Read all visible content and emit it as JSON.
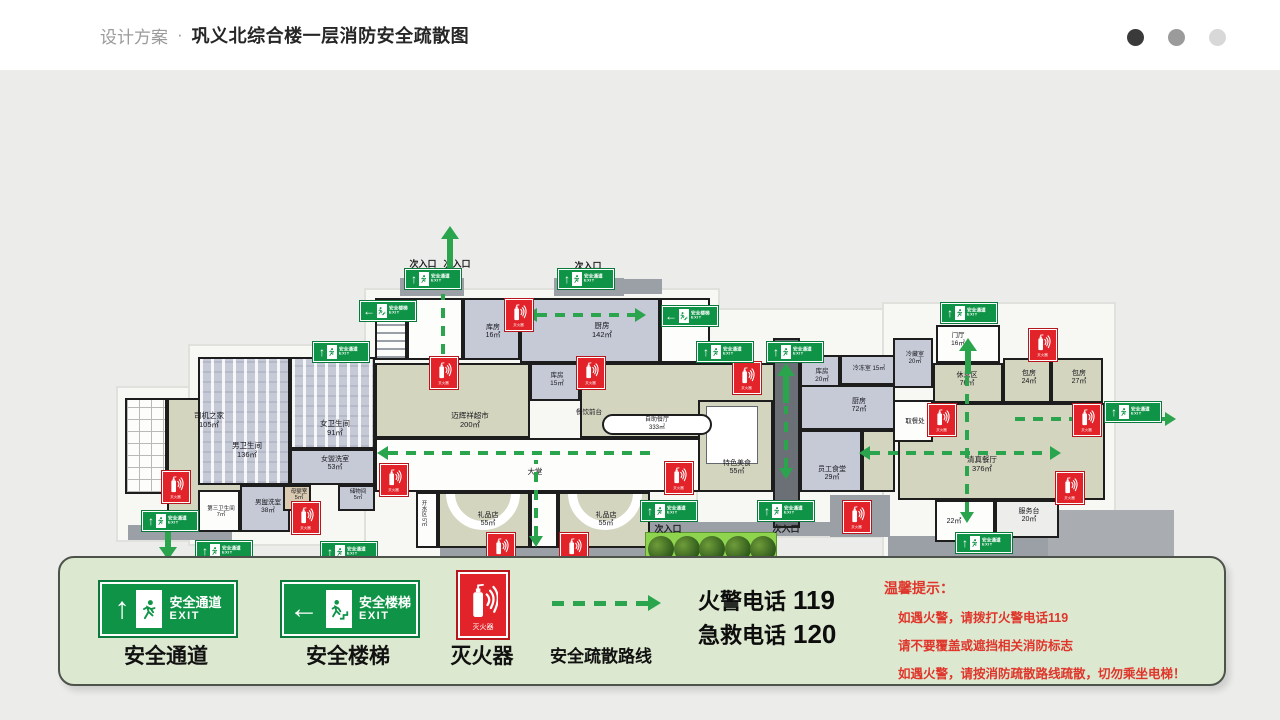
{
  "header": {
    "brand": "设计方案",
    "separator": "·",
    "title": "巩义北综合楼一层消防安全疏散图",
    "dots": [
      "#3a3a3a",
      "#9b9b9b",
      "#d8d8d8"
    ]
  },
  "colors": {
    "exit_green": "#0f9447",
    "extinguisher_red": "#e2232a",
    "route_green": "#2aa44d",
    "legend_bg": "#dce8cf",
    "tips_red": "#e0352b"
  },
  "sign_text": {
    "passage": "安全通道",
    "stairs": "安全楼梯",
    "exit": "EXIT",
    "extinguisher": "灭火器"
  },
  "legend": {
    "items": [
      {
        "label": "安全通道"
      },
      {
        "label": "安全楼梯"
      },
      {
        "label": "灭火器"
      },
      {
        "label": "安全疏散路线"
      }
    ],
    "phones": [
      {
        "label": "火警电话",
        "number": "119"
      },
      {
        "label": "急救电话",
        "number": "120"
      }
    ],
    "tips": {
      "title": "温馨提示：",
      "lines": [
        "如遇火警，请拨打火警电话119",
        "请不要覆盖或遮挡相关消防标志",
        "如遇火警，请按消防疏散路线疏散，切勿乘坐电梯！"
      ]
    }
  },
  "floorplan": {
    "silhouettes": [
      {
        "x": 118,
        "y": 318,
        "w": 138,
        "h": 152
      },
      {
        "x": 190,
        "y": 276,
        "w": 194,
        "h": 198
      },
      {
        "x": 366,
        "y": 220,
        "w": 352,
        "h": 266
      },
      {
        "x": 698,
        "y": 240,
        "w": 202,
        "h": 226
      },
      {
        "x": 884,
        "y": 234,
        "w": 230,
        "h": 258
      }
    ],
    "platforms": [
      {
        "x": 400,
        "y": 208,
        "w": 64,
        "h": 18
      },
      {
        "x": 554,
        "y": 208,
        "w": 70,
        "h": 18
      },
      {
        "x": 610,
        "y": 209,
        "w": 52,
        "h": 15
      },
      {
        "x": 128,
        "y": 455,
        "w": 104,
        "h": 15
      },
      {
        "x": 440,
        "y": 478,
        "w": 208,
        "h": 14
      },
      {
        "x": 490,
        "y": 492,
        "w": 124,
        "h": 24,
        "c": "#8a9095"
      },
      {
        "x": 618,
        "y": 452,
        "w": 218,
        "h": 14
      },
      {
        "x": 830,
        "y": 425,
        "w": 60,
        "h": 42
      },
      {
        "x": 888,
        "y": 466,
        "w": 162,
        "h": 26
      },
      {
        "x": 1048,
        "y": 440,
        "w": 126,
        "h": 58,
        "c": "#a9adb2"
      }
    ],
    "rooms": [
      {
        "x": 125,
        "y": 328,
        "w": 42,
        "h": 96,
        "f": "W",
        "pat": "grid"
      },
      {
        "n": "司机之家",
        "a": "105㎡",
        "x": 167,
        "y": 328,
        "w": 80,
        "h": 128,
        "f": "G",
        "lx": 207,
        "ly": 340
      },
      {
        "n": "男卫生间",
        "a": "136㎡",
        "x": 198,
        "y": 287,
        "w": 92,
        "h": 128,
        "f": "B",
        "pat": "stall",
        "lx": 245,
        "ly": 370
      },
      {
        "n": "女卫生间",
        "a": "91㎡",
        "x": 290,
        "y": 287,
        "w": 85,
        "h": 92,
        "f": "B",
        "pat": "stall",
        "lx": 333,
        "ly": 348
      },
      {
        "n": "女盥洗室",
        "a": "53㎡",
        "x": 290,
        "y": 379,
        "w": 85,
        "h": 36,
        "f": "B",
        "s": 7,
        "lx": 333,
        "ly": 384
      },
      {
        "n": "男盥洗室",
        "a": "38㎡",
        "x": 240,
        "y": 415,
        "w": 50,
        "h": 47,
        "f": "B",
        "s": 6.5,
        "lx": 266,
        "ly": 427
      },
      {
        "n": "第三卫生间",
        "a": "7㎡",
        "x": 198,
        "y": 420,
        "w": 42,
        "h": 42,
        "f": "W",
        "s": 5.5,
        "lx": 219,
        "ly": 434
      },
      {
        "n": "母婴室",
        "a": "5㎡",
        "x": 283,
        "y": 415,
        "w": 28,
        "h": 26,
        "f": "T",
        "s": 5.5,
        "lx": 297,
        "ly": 417
      },
      {
        "n": "储物间",
        "a": "5㎡",
        "x": 338,
        "y": 415,
        "w": 37,
        "h": 26,
        "f": "B",
        "s": 5.5,
        "lx": 356,
        "ly": 417
      },
      {
        "x": 375,
        "y": 228,
        "w": 32,
        "h": 62,
        "f": "W",
        "pat": "stair"
      },
      {
        "x": 407,
        "y": 228,
        "w": 56,
        "h": 62,
        "f": "W"
      },
      {
        "n": "库房",
        "a": "16㎡",
        "x": 463,
        "y": 228,
        "w": 57,
        "h": 62,
        "f": "B",
        "s": 7,
        "lx": 491,
        "ly": 252
      },
      {
        "n": "厨房",
        "a": "142㎡",
        "x": 520,
        "y": 228,
        "w": 140,
        "h": 65,
        "f": "B",
        "lx": 600,
        "ly": 250
      },
      {
        "x": 660,
        "y": 228,
        "w": 50,
        "h": 65,
        "f": "W"
      },
      {
        "n": "库房",
        "a": "15㎡",
        "x": 530,
        "y": 293,
        "w": 50,
        "h": 38,
        "f": "B",
        "s": 6.5,
        "lx": 555,
        "ly": 300
      },
      {
        "n": "迈辉祥超市",
        "a": "200㎡",
        "x": 375,
        "y": 293,
        "w": 155,
        "h": 75,
        "f": "G",
        "lx": 468,
        "ly": 340
      },
      {
        "x": 580,
        "y": 293,
        "w": 195,
        "h": 75,
        "f": "G"
      },
      {
        "n": "大堂",
        "x": 375,
        "y": 368,
        "w": 400,
        "h": 54,
        "f": "W",
        "oneline": true,
        "lx": 533,
        "ly": 396
      },
      {
        "n": "开水区",
        "a": "5㎡",
        "x": 416,
        "y": 422,
        "w": 22,
        "h": 56,
        "f": "W",
        "s": 5.5,
        "vert": true,
        "lx": 424,
        "ly": 428
      },
      {
        "n": "礼品店",
        "a": "55㎡",
        "x": 438,
        "y": 422,
        "w": 92,
        "h": 56,
        "f": "G",
        "pat": "arc",
        "s": 7,
        "lx": 486,
        "ly": 440
      },
      {
        "x": 530,
        "y": 422,
        "w": 28,
        "h": 56,
        "f": "W"
      },
      {
        "n": "礼品店",
        "a": "55㎡",
        "x": 558,
        "y": 422,
        "w": 92,
        "h": 56,
        "f": "G",
        "pat": "arc",
        "mirror": true,
        "s": 7,
        "lx": 604,
        "ly": 440
      },
      {
        "n": "特色美食",
        "a": "55㎡",
        "x": 698,
        "y": 330,
        "w": 75,
        "h": 92,
        "f": "G",
        "pat": "inner",
        "s": 7,
        "lx": 735,
        "ly": 388
      },
      {
        "n": "库房",
        "a": "20㎡",
        "x": 800,
        "y": 285,
        "w": 40,
        "h": 50,
        "f": "B",
        "s": 6.5,
        "lx": 820,
        "ly": 296
      },
      {
        "n": "冷冻室 15㎡",
        "x": 840,
        "y": 285,
        "w": 55,
        "h": 30,
        "f": "B",
        "s": 6,
        "oneline": true,
        "lx": 867,
        "ly": 294
      },
      {
        "n": "厨房",
        "a": "72㎡",
        "x": 800,
        "y": 315,
        "w": 95,
        "h": 45,
        "f": "B",
        "s": 7,
        "lx": 857,
        "ly": 326
      },
      {
        "n": "员工食堂",
        "a": "29㎡",
        "x": 800,
        "y": 360,
        "w": 62,
        "h": 62,
        "f": "B",
        "s": 7,
        "lx": 830,
        "ly": 394
      },
      {
        "x": 862,
        "y": 360,
        "w": 33,
        "h": 62,
        "f": "G"
      },
      {
        "n": "清真餐厅",
        "a": "376㎡",
        "x": 898,
        "y": 333,
        "w": 207,
        "h": 97,
        "f": "G",
        "lx": 980,
        "ly": 384
      },
      {
        "n": "取餐处",
        "x": 893,
        "y": 330,
        "w": 40,
        "h": 42,
        "f": "W",
        "s": 6.5,
        "oneline": true,
        "lx": 913,
        "ly": 346
      },
      {
        "n": "冷藏室",
        "a": "20㎡",
        "x": 893,
        "y": 268,
        "w": 40,
        "h": 50,
        "f": "B",
        "s": 6,
        "lx": 913,
        "ly": 280
      },
      {
        "n": "门厅",
        "a": "16㎡",
        "x": 936,
        "y": 255,
        "w": 64,
        "h": 38,
        "f": "W",
        "s": 6.5,
        "lx": 956,
        "ly": 260
      },
      {
        "n": "休息区",
        "a": "76㎡",
        "x": 933,
        "y": 293,
        "w": 70,
        "h": 40,
        "f": "G",
        "s": 7,
        "lx": 965,
        "ly": 300
      },
      {
        "n": "包房",
        "a": "24㎡",
        "x": 1003,
        "y": 288,
        "w": 48,
        "h": 45,
        "f": "G",
        "s": 7,
        "lx": 1027,
        "ly": 298
      },
      {
        "n": "包房",
        "a": "27㎡",
        "x": 1051,
        "y": 288,
        "w": 52,
        "h": 45,
        "f": "G",
        "s": 7,
        "lx": 1077,
        "ly": 298
      },
      {
        "n": "22㎡",
        "x": 935,
        "y": 430,
        "w": 60,
        "h": 42,
        "f": "W",
        "s": 7,
        "oneline": true,
        "lx": 952,
        "ly": 446
      },
      {
        "n": "服务台",
        "a": "20㎡",
        "x": 995,
        "y": 430,
        "w": 64,
        "h": 38,
        "f": "W2",
        "s": 7,
        "lx": 1027,
        "ly": 436
      }
    ],
    "corridor": {
      "x": 773,
      "y": 268,
      "w": 27,
      "h": 190
    },
    "pill": {
      "x": 602,
      "y": 344,
      "w": 110,
      "h": 21,
      "line1": "自助餐厅",
      "line2": "333㎡"
    },
    "extra_labels": [
      {
        "t": "餐饮前台",
        "x": 589,
        "y": 336,
        "s": 6.5
      }
    ],
    "entrances": [
      {
        "t": "次入口",
        "x": 423,
        "y": 187
      },
      {
        "t": "次入口",
        "x": 457,
        "y": 187
      },
      {
        "t": "次入口",
        "x": 588,
        "y": 189
      },
      {
        "t": "主入口",
        "x": 533,
        "y": 518
      },
      {
        "t": "次入口",
        "x": 668,
        "y": 452
      },
      {
        "t": "次入口",
        "x": 786,
        "y": 452
      },
      {
        "t": "次入口",
        "x": 982,
        "y": 484
      }
    ],
    "exit_signs": [
      {
        "x": 405,
        "y": 199,
        "t": "p"
      },
      {
        "x": 558,
        "y": 199,
        "t": "p"
      },
      {
        "x": 360,
        "y": 231,
        "t": "s"
      },
      {
        "x": 313,
        "y": 272,
        "t": "p"
      },
      {
        "x": 662,
        "y": 236,
        "t": "s"
      },
      {
        "x": 697,
        "y": 272,
        "t": "p"
      },
      {
        "x": 767,
        "y": 272,
        "t": "p"
      },
      {
        "x": 941,
        "y": 233,
        "t": "p"
      },
      {
        "x": 1105,
        "y": 332,
        "t": "p"
      },
      {
        "x": 142,
        "y": 441,
        "t": "p"
      },
      {
        "x": 196,
        "y": 471,
        "t": "p"
      },
      {
        "x": 321,
        "y": 472,
        "t": "p"
      },
      {
        "x": 505,
        "y": 496,
        "t": "p"
      },
      {
        "x": 641,
        "y": 431,
        "t": "p"
      },
      {
        "x": 758,
        "y": 431,
        "t": "p"
      },
      {
        "x": 956,
        "y": 463,
        "t": "p"
      }
    ],
    "ext_signs": [
      {
        "x": 505,
        "y": 229
      },
      {
        "x": 430,
        "y": 287
      },
      {
        "x": 577,
        "y": 287
      },
      {
        "x": 162,
        "y": 401
      },
      {
        "x": 292,
        "y": 432
      },
      {
        "x": 380,
        "y": 394
      },
      {
        "x": 665,
        "y": 392
      },
      {
        "x": 733,
        "y": 292
      },
      {
        "x": 843,
        "y": 431
      },
      {
        "x": 1029,
        "y": 259
      },
      {
        "x": 928,
        "y": 334
      },
      {
        "x": 1073,
        "y": 334
      },
      {
        "x": 1056,
        "y": 402
      },
      {
        "x": 487,
        "y": 463
      },
      {
        "x": 560,
        "y": 463
      }
    ],
    "routes": [
      {
        "o": "h",
        "x": 537,
        "y": 245,
        "len": 98,
        "heads": "lr"
      },
      {
        "o": "v",
        "x": 443,
        "y": 224,
        "len": 60,
        "heads": ""
      },
      {
        "o": "h",
        "x": 388,
        "y": 383,
        "len": 270,
        "heads": "l"
      },
      {
        "o": "v",
        "x": 536,
        "y": 390,
        "len": 76,
        "heads": "b"
      },
      {
        "o": "h",
        "x": 870,
        "y": 383,
        "len": 180,
        "heads": "lr"
      },
      {
        "o": "h",
        "x": 1015,
        "y": 349,
        "len": 150,
        "heads": "r"
      },
      {
        "o": "v",
        "x": 967,
        "y": 302,
        "len": 140,
        "heads": "b"
      },
      {
        "o": "v",
        "x": 786,
        "y": 336,
        "len": 62,
        "heads": "b"
      }
    ],
    "arrows": [
      {
        "x": 450,
        "y": 156,
        "h": 44,
        "dir": "up"
      },
      {
        "x": 968,
        "y": 268,
        "h": 36,
        "dir": "up"
      },
      {
        "x": 786,
        "y": 293,
        "h": 40,
        "dir": "up"
      },
      {
        "x": 168,
        "y": 462,
        "h": 28,
        "dir": "down"
      },
      {
        "x": 222,
        "y": 492,
        "h": 30,
        "dir": "down"
      },
      {
        "x": 345,
        "y": 494,
        "h": 30,
        "dir": "down"
      }
    ],
    "shrubs": {
      "x": 645,
      "y": 462,
      "w": 132,
      "h": 32,
      "count": 5
    }
  }
}
